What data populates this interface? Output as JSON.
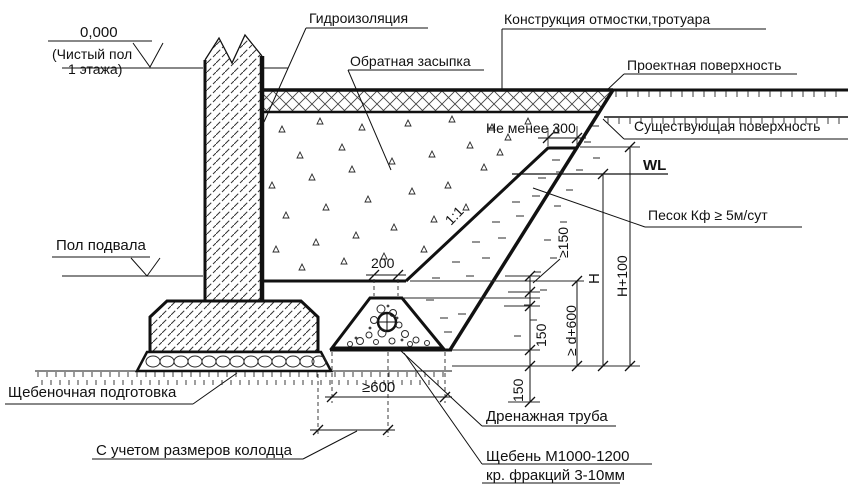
{
  "levels": {
    "zero": "0,000",
    "zero_note_1": "(Чистый пол",
    "zero_note_2": "1 этажа)",
    "basement": "Пол подвала"
  },
  "callouts": {
    "waterproofing": "Гидроизоляция",
    "backfill": "Обратная засыпка",
    "pavement": "Конструкция отмостки,тротуара",
    "design_surface": "Проектная поверхность",
    "existing_surface": "Существующая поверхность",
    "sand": "Песок Кф ≥ 5м/сут",
    "gravel_prep": "Щебеночная подготовка",
    "drain_pipe": "Дренажная труба",
    "well_size": "С учетом размеров колодца",
    "crushed_stone_1": "Щебень М1000-1200",
    "crushed_stone_2": "кр. фракций 3-10мм"
  },
  "dims": {
    "min300": "Не менее 300",
    "water_level": "WL",
    "slope": "1:1",
    "top_width": "200",
    "min150": "≥150",
    "h": "H",
    "h_plus_100": "H+100",
    "prism_height": "150",
    "d_plus_600": "≥ d+600",
    "bed_height": "150",
    "min600": "≥600"
  }
}
